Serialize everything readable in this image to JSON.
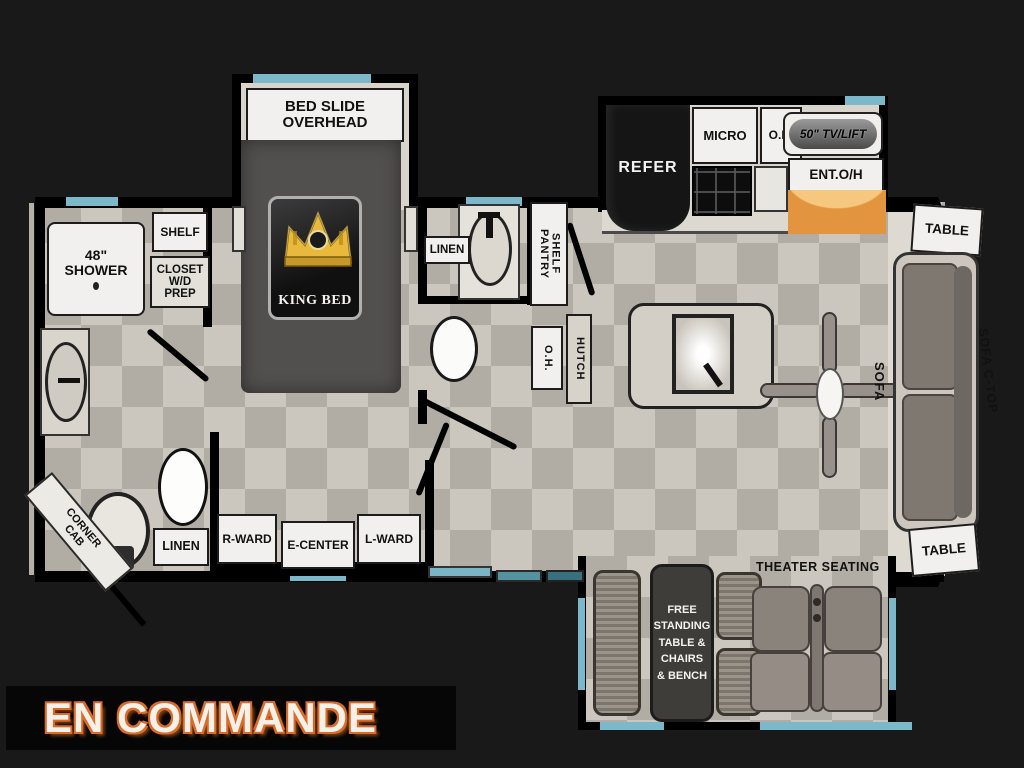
{
  "title_banner": "EN COMMANDE",
  "colors": {
    "background": "#191919",
    "wall": "#000000",
    "floor": "#c0bab0",
    "accent_blue": "#7ab8ca",
    "accent_orange": "#e2953e",
    "badge_gold": "#e8b93a"
  },
  "floorplan": {
    "bedroom": {
      "bed_slide_line1": "BED SLIDE",
      "bed_slide_line2": "OVERHEAD",
      "king_bed": "KING BED",
      "r_ward": "R-WARD",
      "e_center": "E-CENTER",
      "l_ward": "L-WARD"
    },
    "front_bath": {
      "shower_line1": "48\"",
      "shower_line2": "SHOWER",
      "shelf": "SHELF",
      "closet_line1": "CLOSET",
      "closet_line2": "W/D PREP",
      "corner_cab_line1": "CORNER",
      "corner_cab_line2": "CAB",
      "linen": "LINEN"
    },
    "mid_bath": {
      "linen": "LINEN",
      "pantry_line1": "PANTRY",
      "pantry_line2": "SHELF",
      "oh": "O.H.",
      "hutch": "HUTCH"
    },
    "kitchen": {
      "refer": "REFER",
      "micro": "MICRO",
      "oh": "O.H.",
      "tv_lift": "50\" TV/LIFT",
      "ent_oh": "ENT.O/H"
    },
    "living": {
      "table_rear_top": "TABLE",
      "table_rear_bottom": "TABLE",
      "sofa": "SOFA",
      "sofa_ctop": "SOFA C-TOP",
      "theater": "THEATER SEATING",
      "free_standing_line1": "FREE",
      "free_standing_line2": "STANDING",
      "free_standing_line3": "TABLE &",
      "free_standing_line4": "CHAIRS",
      "free_standing_line5": "& BENCH"
    }
  }
}
